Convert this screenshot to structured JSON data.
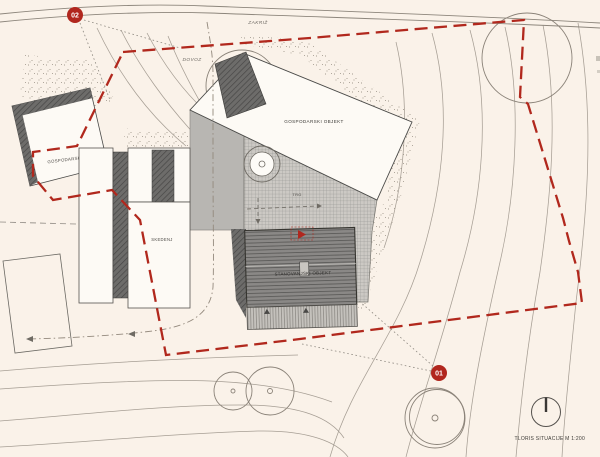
{
  "drawing": {
    "caption": "TLORIS SITUACIJE M 1:200",
    "scale": "M 1:200"
  },
  "place_labels": {
    "zakriz": "ZAKRIŽ",
    "dovoz": "DOVOZ"
  },
  "buildings": {
    "gospodarski_left": "GOSPODARSKI OBJEKT",
    "gospodarski_main": "GOSPODARSKI OBJEKT",
    "skedenj": "SKEDENJ",
    "stanovanjski": "STANOVANJSKI OBJEKT",
    "trg": "TRG"
  },
  "markers": {
    "m01": "01",
    "m02": "02"
  },
  "colors": {
    "background": "#faf2e9",
    "boundary_red": "#b1281d",
    "marker_red": "#b1271e",
    "building_dark": "#6d6c6a",
    "roof_gray": "#8a8886",
    "plaza_gray": "#b8b6b2",
    "grid_gray": "#ccc9c4",
    "contour_gray": "#a69e94",
    "outline_dark": "#4a4a48"
  }
}
